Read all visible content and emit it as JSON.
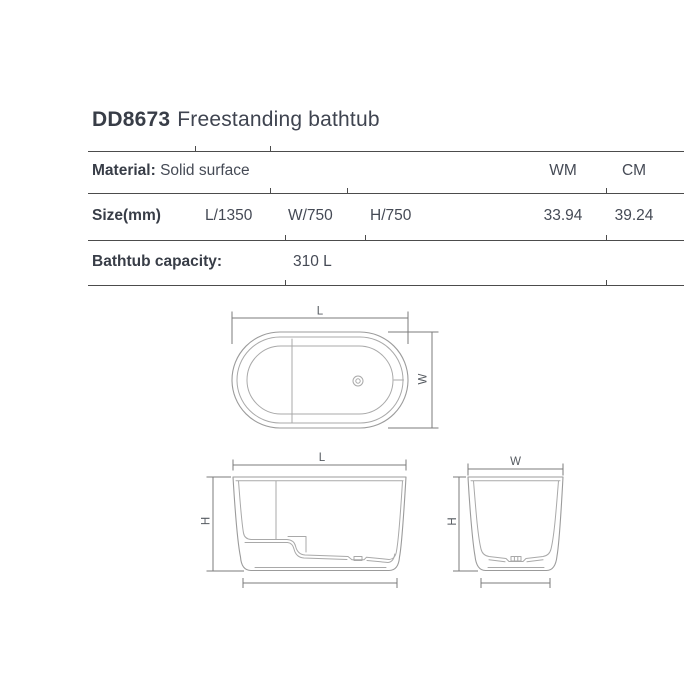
{
  "title": {
    "model": "DD8673",
    "name": "Freestanding bathtub"
  },
  "table": {
    "units": {
      "wm": "WM",
      "cm": "CM"
    },
    "material": {
      "label": "Material:",
      "value": "Solid surface"
    },
    "size": {
      "label": "Size(mm)",
      "length": "L/1350",
      "width": "W/750",
      "height": "H/750",
      "wm_value": "33.94",
      "cm_value": "39.24"
    },
    "capacity": {
      "label": "Bathtub capacity:",
      "value": "310 L"
    }
  },
  "drawings": {
    "top_view": {
      "length": "L",
      "width": "W"
    },
    "front_view": {
      "length": "L",
      "height": "H"
    },
    "side_view": {
      "width": "W",
      "height": "H"
    }
  },
  "colors": {
    "text": "#3f4450",
    "table_line": "#4c4c4c",
    "drawing_line": "#9b9b9b",
    "dimension_line": "#7b7b7b"
  }
}
